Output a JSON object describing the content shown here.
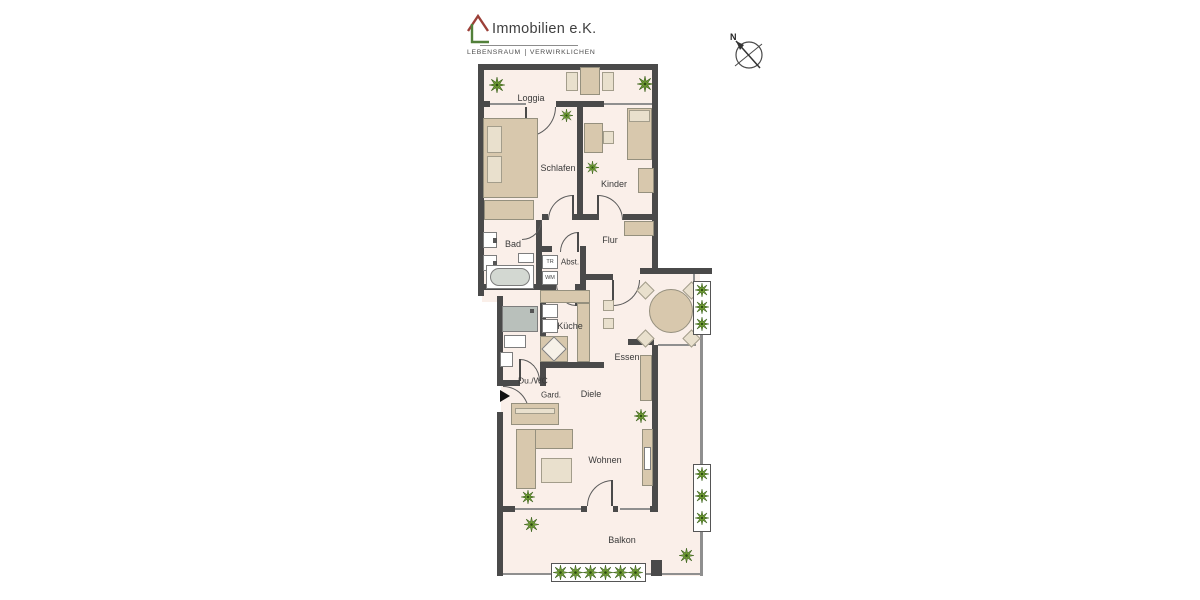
{
  "logo": {
    "name": "Immobilien e.K.",
    "tagline_left": "LEBENSRAUM",
    "tagline_right": "VERWIRKLICHEN"
  },
  "compass": {
    "north_label": "N"
  },
  "plan": {
    "rooms": {
      "loggia": "Loggia",
      "schlafen": "Schlafen",
      "kinder": "Kinder",
      "bad": "Bad",
      "flur": "Flur",
      "abstellraum": "Abst.",
      "kueche": "Küche",
      "essen": "Essen",
      "dusche_wc": "Du./WC",
      "garderobe": "Gard.",
      "diele": "Diele",
      "wohnen": "Wohnen",
      "balkon": "Balkon"
    },
    "appliances": {
      "trockner": "TR",
      "waschmaschine": "WM"
    }
  },
  "colors": {
    "wall": "#4a4a4a",
    "floor": "#faefe9",
    "furniture": "#d8c8ad",
    "plant": "#6f9c33",
    "logo_roof": "#9c4038",
    "logo_l": "#52803a"
  }
}
